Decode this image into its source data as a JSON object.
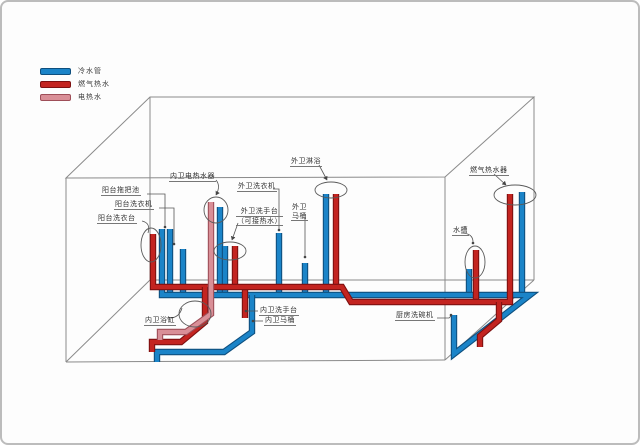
{
  "legend": {
    "items": [
      {
        "id": "cold-water",
        "label": "冷水管",
        "color": "#1b84c8"
      },
      {
        "id": "gas-hot-water",
        "label": "燃气热水",
        "color": "#c32420"
      },
      {
        "id": "electric-hot-water",
        "label": "电热水",
        "color": "#d98f97"
      }
    ]
  },
  "callouts": {
    "balcony_mop_pool": "阳台拖把池",
    "balcony_washer": "阳台洗衣机",
    "balcony_wash_counter": "阳台洗衣台",
    "inner_bath_electric_heater": "内卫电热水器",
    "outer_bath_washer": "外卫洗衣机",
    "outer_bath_basin_line1": "外卫洗手台",
    "outer_bath_basin_line2": "（可接热水）",
    "outer_bath_toilet_line1": "外卫",
    "outer_bath_toilet_line2": "马桶",
    "outer_bath_shower": "外卫淋浴",
    "gas_water_heater": "燃气热水器",
    "sink": "水槽",
    "inner_bath_tub": "内卫浴缸",
    "inner_bath_basin": "内卫洗手台",
    "inner_bath_toilet": "内卫马桶",
    "kitchen_dishwasher": "厨房洗碗机"
  },
  "colors": {
    "cold_water": "#1b84c8",
    "gas_hot_water": "#c32420",
    "electric_hot_water": "#d98f97",
    "room_outline": "#8a8a8a"
  }
}
